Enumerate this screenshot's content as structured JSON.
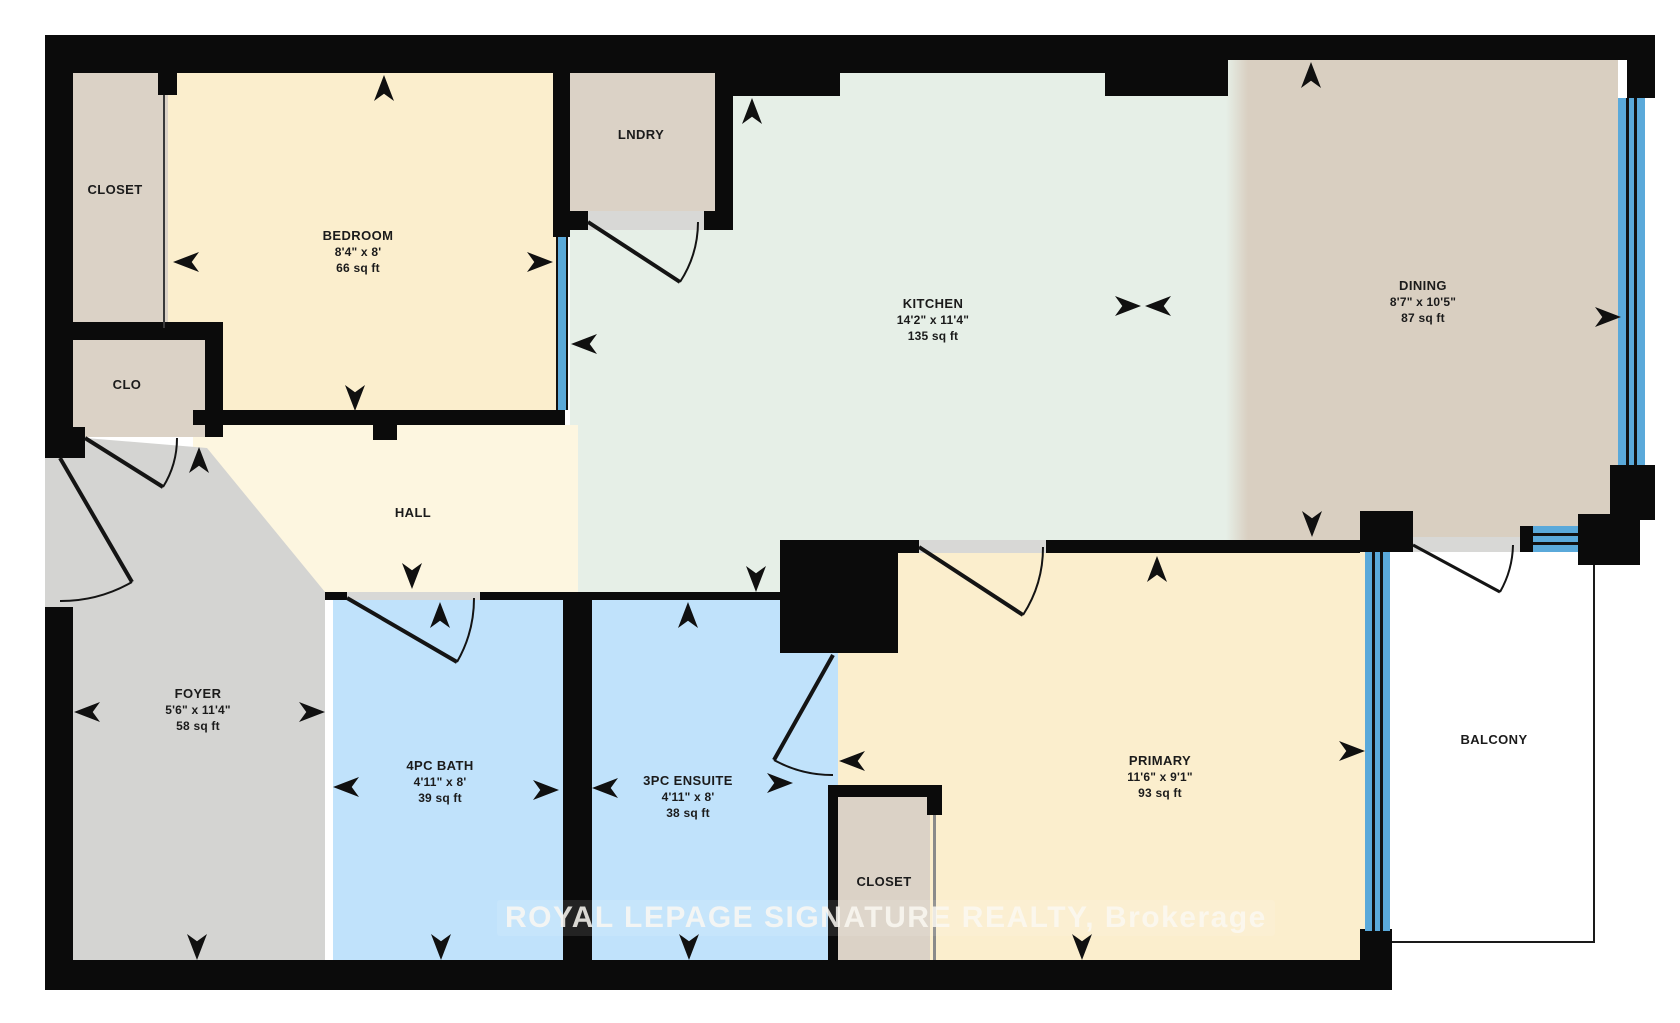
{
  "plan": {
    "watermark": "ROYAL LEPAGE SIGNATURE REALTY, Brokerage",
    "colors": {
      "wall": "#0b0b0b",
      "window_glass": "#5aa9da",
      "floor_bedroom_primary": "#fbeecd",
      "floor_hall": "#fdf6e0",
      "floor_kitchen": "#e6efe7",
      "floor_dining": "#d9cfc1",
      "floor_closet_laundry": "#dbd2c6",
      "floor_foyer": "#d4d4d2",
      "floor_bath": "#c0e2fb",
      "floor_balcony": "#ffffff"
    },
    "rooms": {
      "closet_top": {
        "name": "CLOSET"
      },
      "bedroom": {
        "name": "BEDROOM",
        "dimensions": "8'4\" x 8'",
        "area": "66 sq ft"
      },
      "clo": {
        "name": "CLO"
      },
      "laundry": {
        "name": "LNDRY"
      },
      "kitchen": {
        "name": "KITCHEN",
        "dimensions": "14'2\" x 11'4\"",
        "area": "135 sq ft"
      },
      "dining": {
        "name": "DINING",
        "dimensions": "8'7\" x 10'5\"",
        "area": "87 sq ft"
      },
      "hall": {
        "name": "HALL"
      },
      "foyer": {
        "name": "FOYER",
        "dimensions": "5'6\" x 11'4\"",
        "area": "58 sq ft"
      },
      "bath": {
        "name": "4PC BATH",
        "dimensions": "4'11\" x 8'",
        "area": "39 sq ft"
      },
      "ensuite": {
        "name": "3PC ENSUITE",
        "dimensions": "4'11\" x 8'",
        "area": "38 sq ft"
      },
      "closet_primary": {
        "name": "CLOSET"
      },
      "primary": {
        "name": "PRIMARY",
        "dimensions": "11'6\" x 9'1\"",
        "area": "93 sq ft"
      },
      "balcony": {
        "name": "BALCONY"
      }
    }
  }
}
